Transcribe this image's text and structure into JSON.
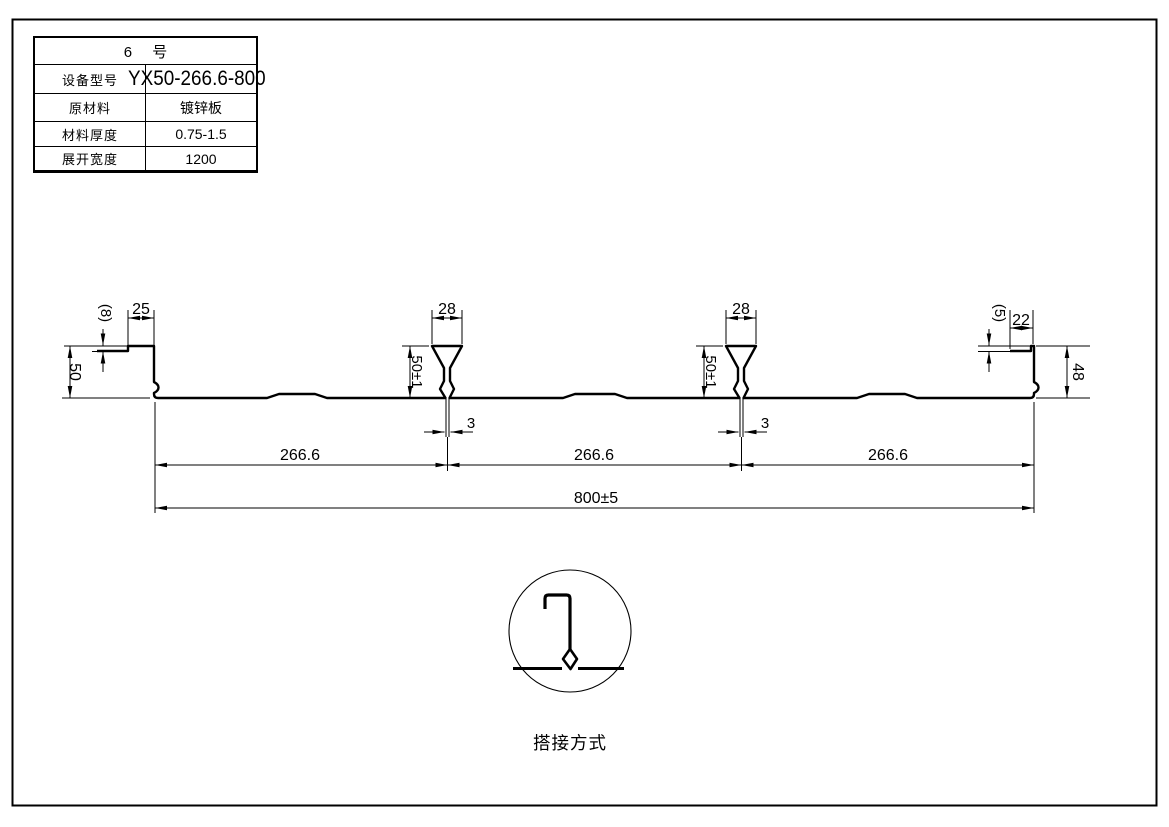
{
  "table": {
    "title": "6 号",
    "rows": [
      {
        "label": "设备型号",
        "value": "YX50-266.6-800"
      },
      {
        "label": "原材料",
        "value": "镀锌板"
      },
      {
        "label": "材料厚度",
        "value": "0.75-1.5"
      },
      {
        "label": "展开宽度",
        "value": "1200"
      }
    ]
  },
  "dims": {
    "left_lip_step": "(8)",
    "left_top_flange": "25",
    "left_height": "50",
    "rib_top_width": "28",
    "rib_height": "50±1",
    "rib_stem_width": "3",
    "right_lip_step": "(5)",
    "right_lip_width": "22",
    "right_height": "48",
    "span": "266.6",
    "overall_width": "800±5"
  },
  "detail": {
    "caption": "搭接方式"
  },
  "colors": {
    "line": "#000000",
    "background": "#ffffff"
  }
}
